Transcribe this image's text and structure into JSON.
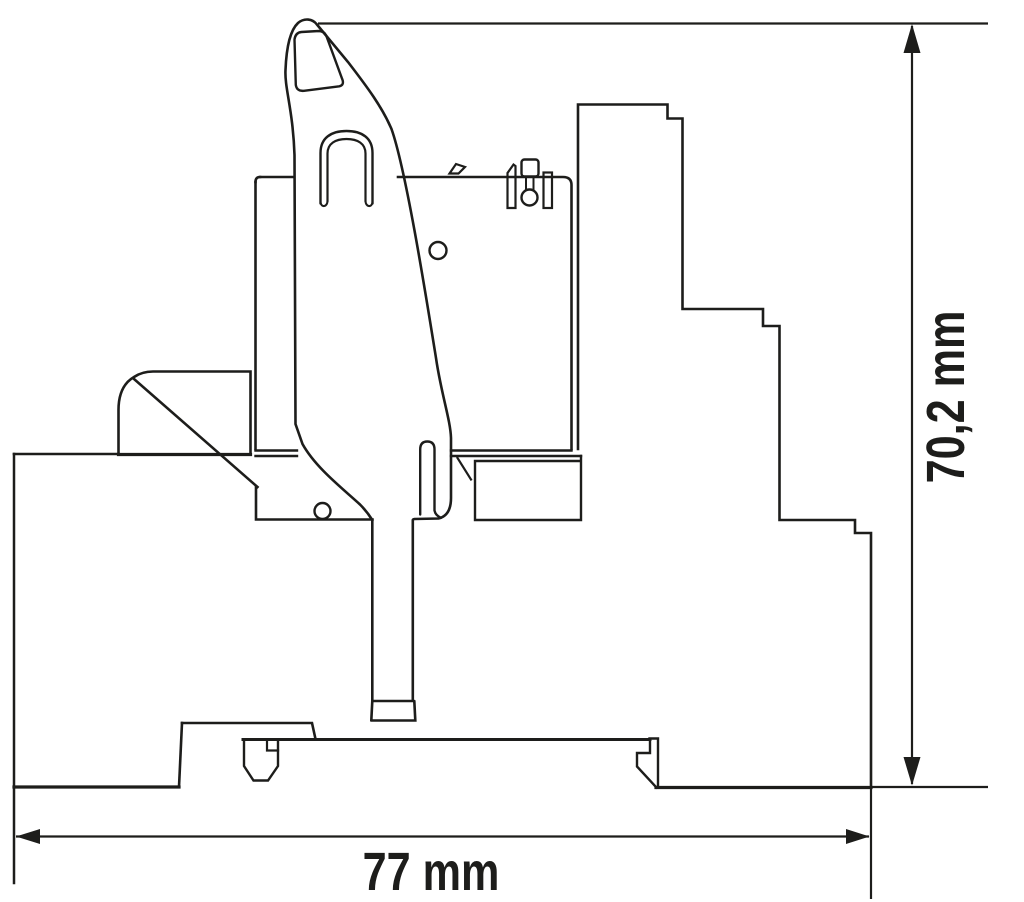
{
  "figure": {
    "type": "technical dimension drawing",
    "subject": "relay module with release lever on DIN rail, side view",
    "background_color": "#ffffff",
    "line_color": "#1d1d1b"
  },
  "dimensions": {
    "width": {
      "label": "77 mm"
    },
    "height": {
      "label": "70,2 mm"
    }
  }
}
